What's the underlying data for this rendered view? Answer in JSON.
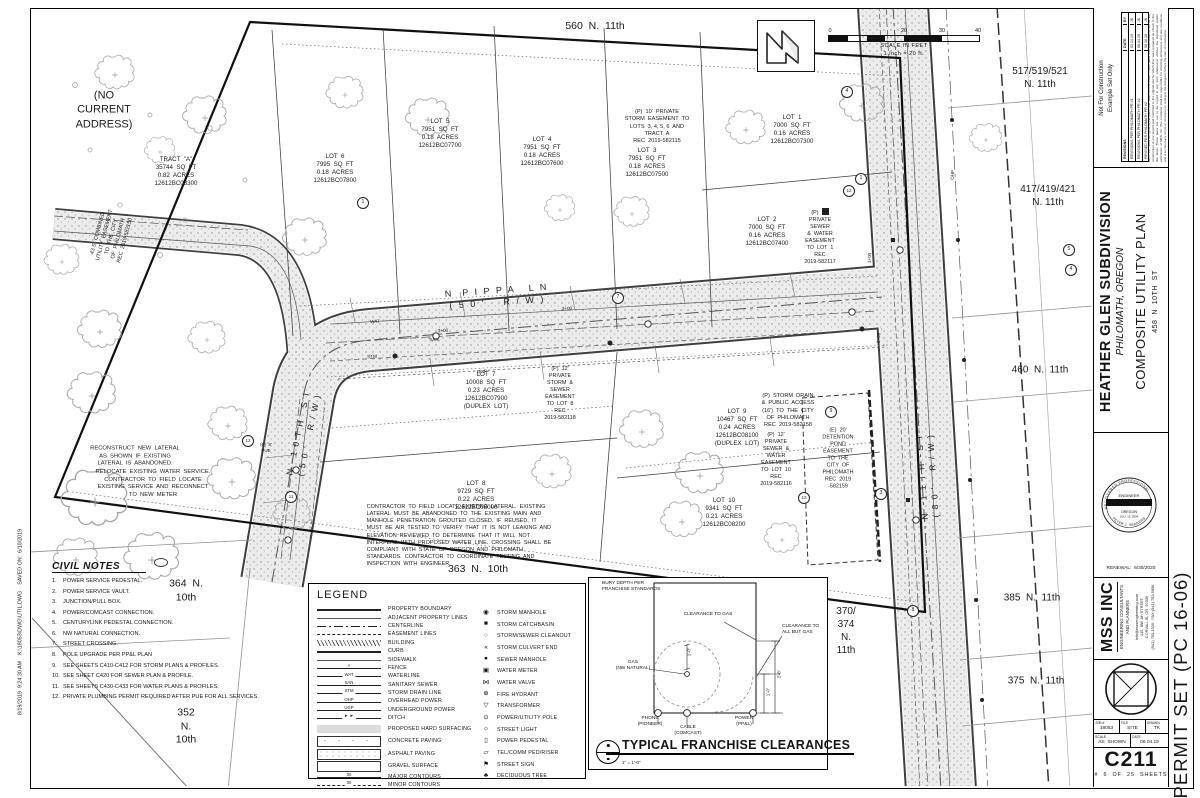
{
  "plan": {
    "annotations": [
      {
        "n": "addr-560",
        "t": "560  N.  11th",
        "x": 595,
        "y": 27,
        "fs": 10.5
      },
      {
        "n": "no-current-address",
        "t": "(NO\nCURRENT\nADDRESS)",
        "x": 104,
        "y": 110,
        "fs": 11
      },
      {
        "n": "addr-517-519-521",
        "t": "517/519/521\nN. 11th",
        "x": 1040,
        "y": 78,
        "fs": 10
      },
      {
        "n": "addr-417-419-421",
        "t": "417/419/421\nN. 11th",
        "x": 1048,
        "y": 196,
        "fs": 10
      },
      {
        "n": "addr-460",
        "t": "460  N.  11th",
        "x": 1040,
        "y": 370,
        "fs": 10
      },
      {
        "n": "addr-385",
        "t": "385  N.  11th",
        "x": 1032,
        "y": 598,
        "fs": 10
      },
      {
        "n": "addr-375",
        "t": "375  N.  11th",
        "x": 1036,
        "y": 681,
        "fs": 10
      },
      {
        "n": "addr-370-374",
        "t": "370/\n374\nN.\n11th",
        "x": 846,
        "y": 631,
        "fs": 10
      },
      {
        "n": "addr-364",
        "t": "364  N.\n10th",
        "x": 186,
        "y": 591,
        "fs": 10.5
      },
      {
        "n": "addr-352",
        "t": "352\nN.\n10th",
        "x": 186,
        "y": 727,
        "fs": 10.5
      },
      {
        "n": "addr-363",
        "t": "363  N.  10th",
        "x": 478,
        "y": 570,
        "fs": 10.5
      },
      {
        "n": "street-n-pippa-ln",
        "t": "N  P I P P A   L N\n( 5 0 '    R / W )",
        "x": 497,
        "y": 297,
        "fs": 9,
        "rot": -4,
        "ls": 2
      },
      {
        "n": "street-n-10th-st",
        "t": "N   1 0 T H   S T\n( 5 0 '    R / W )",
        "x": 304,
        "y": 434,
        "fs": 8.5,
        "rot": -78,
        "ls": 1.5
      },
      {
        "n": "street-n-11th-st",
        "t": "N   1 1 T H   S T\n( 8 0 '    R / W )",
        "x": 928,
        "y": 476,
        "fs": 8.5,
        "rot": -94,
        "ls": 1.5
      },
      {
        "n": "tract-a-label",
        "t": "TRACT  \"A\"\n35744  SQ  FT\n0.82  ACRES\n12612BC08300",
        "x": 176,
        "y": 172,
        "fs": 6.2
      },
      {
        "n": "lot-6-label",
        "t": "LOT  6\n7995  SQ  FT\n0.18  ACRES\n12612BC07800",
        "x": 335,
        "y": 169,
        "fs": 6.2
      },
      {
        "n": "lot-5-label",
        "t": "LOT  5\n7951  SQ  FT\n0.18  ACRES\n12612BC07700",
        "x": 440,
        "y": 134,
        "fs": 6.2
      },
      {
        "n": "lot-4-label",
        "t": "LOT  4\n7951  SQ  FT\n0.18  ACRES\n12612BC07600",
        "x": 542,
        "y": 152,
        "fs": 6.2
      },
      {
        "n": "lot-3-label",
        "t": "LOT  3\n7951  SQ  FT\n0.18  ACRES\n12612BC07500",
        "x": 647,
        "y": 163,
        "fs": 6.2
      },
      {
        "n": "lot-1-label",
        "t": "LOT  1\n7000  SQ  FT\n0.16  ACRES\n12612BC07300",
        "x": 792,
        "y": 130,
        "fs": 6.2
      },
      {
        "n": "lot-2-label",
        "t": "LOT  2\n7000  SQ  FT\n0.16  ACRES\n12612BC07400",
        "x": 767,
        "y": 232,
        "fs": 6.2
      },
      {
        "n": "lot-7-label",
        "t": "LOT  7\n10008  SQ  FT\n0.23  ACRES\n12612BC07900\n(DUPLEX  LOT)",
        "x": 486,
        "y": 391,
        "fs": 6.2
      },
      {
        "n": "lot-8-label",
        "t": "LOT  8\n9729  SQ  FT\n0.22  ACRES\n12612BC08000",
        "x": 476,
        "y": 496,
        "fs": 6.2
      },
      {
        "n": "lot-9-label",
        "t": "LOT  9\n10467  SQ  FT\n0.24  ACRES\n12612BC08100\n(DUPLEX  LOT)",
        "x": 737,
        "y": 428,
        "fs": 6.2
      },
      {
        "n": "lot-10-label",
        "t": "LOT  10\n9341  SQ  FT\n0.21  ACRES\n12612BC08200",
        "x": 724,
        "y": 513,
        "fs": 6.2
      },
      {
        "n": "esmt-storm-lots-3456",
        "t": "(P)  10'  PRIVATE\nSTORM  EASEMENT  TO\nLOTS  3, 4, 5, 6  AND\nTRACT  A\nREC  2019-582115",
        "x": 657,
        "y": 127,
        "fs": 5.6
      },
      {
        "n": "esmt-sewer-water-lot1",
        "t": "(P)  12'\nPRIVATE\nSEWER\n&  WATER\nEASEMENT\nTO  LOT  1\nREC\n2019-582117",
        "x": 820,
        "y": 238,
        "fs": 5.4
      },
      {
        "n": "esmt-storm-sewer-lot8",
        "t": "(P)  12'\nPRIVATE\nSTORM  &\nSEWER\nEASEMENT\nTO  LOT  8\nREC\n2019-582118",
        "x": 560,
        "y": 394,
        "fs": 5.4
      },
      {
        "n": "esmt-storm-drain-public",
        "t": "(P)  STORM  DRAIN\n&  PUBLIC  ACCESS\n(16')  TO  THE  CITY\nOF  PHILOMATH\nREC  2019-582158",
        "x": 788,
        "y": 411,
        "fs": 5.6
      },
      {
        "n": "esmt-sewer-water-lot10",
        "t": "(P)  12'\nPRIVATE\nSEWER  &\nWATER\nEASEMENT\nTO  LOT  10\nREC\n2019-582116",
        "x": 776,
        "y": 460,
        "fs": 5.4
      },
      {
        "n": "esmt-detention-pond",
        "t": "(E)  20'\nDETENTION\nPOND\nEASEMENT\nTO  THE\nCITY  OF\nPHILOMATH\nREC  2019\n-582159",
        "x": 838,
        "y": 459,
        "fs": 5.4
      },
      {
        "n": "esmt-combined-utility",
        "t": "43.5'  COMBINED\nUTILITY  EASEMENT\nTO  THE  CITY\nOF  PHILOMATH\nREC  2019-582150",
        "x": 112,
        "y": 237,
        "fs": 5.4,
        "rot": -75
      },
      {
        "n": "note-reconstruct-lateral",
        "t": "RECONSTRUCT  NEW  LATERAL\nAS  SHOWN  IF  EXISTING\nLATERAL  IS  ABANDONED.",
        "x": 135,
        "y": 457,
        "fs": 5.8
      },
      {
        "n": "note-relocate-water",
        "t": "RELOCATE  EXISTING  WATER  SERVICE.\nCONTRACTOR  TO  FIELD  LOCATE\nEXISTING  SERVICE  AND  RECONNECT\nTO  NEW  METER",
        "x": 153,
        "y": 484,
        "fs": 5.8
      },
      {
        "n": "note-contractor-lateral",
        "t": "CONTRACTOR  TO  FIELD  LOCATE  EXISTING  LATERAL.  EXISTING\nLATERAL  MUST  BE  ABANDONED  TO  THE  EXISTING  MAIN  AND\nMANHOLE  PENETRATION  GROUTED  CLOSED.  IF  REUSED,  IT\nMUST  BE  AIR  TESTED  TO  VERIFY  THAT  IT  IS  NOT  LEAKING  AND\nELEVATION  REVIEWED  TO  DETERMINE  THAT  IT  WILL  NOT\nINTERFERE  WITH  PROPOSED  WATER  LINE.  CROSSING  SHALL  BE\nCOMPLIANT  WITH  STATE  OF  OREGON  AND  PHILOMATH\nSTANDARDS.  CONTRACTOR  TO  COORDINATE  TESTING  AND\nINSPECTION  WITH  ENGINEER.",
        "x": 459,
        "y": 536,
        "fs": 5.5,
        "al": "left"
      },
      {
        "n": "pue-note",
        "t": "(E)  8'\nPUE",
        "x": 266,
        "y": 448,
        "fs": 4.5
      },
      {
        "n": "utility-tag-wat",
        "t": "WAT",
        "x": 375,
        "y": 322,
        "fs": 4.6,
        "rot": -3
      },
      {
        "n": "utility-tag-san",
        "t": "SAN",
        "x": 434,
        "y": 340,
        "fs": 4.6,
        "rot": -3
      },
      {
        "n": "utility-tag-stm",
        "t": "STM",
        "x": 372,
        "y": 357,
        "fs": 4.6,
        "rot": -3
      },
      {
        "n": "utility-tag-ugp",
        "t": "UGP",
        "x": 482,
        "y": 372,
        "fs": 4.6,
        "rot": -3
      },
      {
        "n": "utility-tag-ohp",
        "t": "OHP",
        "x": 953,
        "y": 175,
        "fs": 4.6,
        "rot": -87
      },
      {
        "n": "station-3-00-a",
        "t": "3+00",
        "x": 443,
        "y": 331,
        "fs": 4.6,
        "rot": -3
      },
      {
        "n": "station-3-00-b",
        "t": "3+00",
        "x": 567,
        "y": 309,
        "fs": 4.6,
        "rot": -3
      },
      {
        "n": "station-1-00",
        "t": "1+00",
        "x": 870,
        "y": 258,
        "fs": 4.6,
        "rot": -87
      },
      {
        "n": "station-0-00",
        "t": "0+00",
        "x": 879,
        "y": 338,
        "fs": 4.6,
        "rot": -87
      },
      {
        "n": "callout-1a",
        "t": "1",
        "x": 363,
        "y": 203,
        "fs": 5.2,
        "c": true
      },
      {
        "n": "callout-4a",
        "t": "4",
        "x": 847,
        "y": 92,
        "fs": 5.2,
        "c": true
      },
      {
        "n": "callout-1b",
        "t": "1",
        "x": 861,
        "y": 179,
        "fs": 5.2,
        "c": true
      },
      {
        "n": "callout-12a",
        "t": "12",
        "x": 849,
        "y": 191,
        "fs": 4.6,
        "c": true
      },
      {
        "n": "callout-7",
        "t": "7",
        "x": 618,
        "y": 298,
        "fs": 5.2,
        "c": true
      },
      {
        "n": "callout-9",
        "t": "9",
        "x": 831,
        "y": 412,
        "fs": 5.2,
        "c": true
      },
      {
        "n": "callout-3",
        "t": "3",
        "x": 881,
        "y": 494,
        "fs": 5.2,
        "c": true
      },
      {
        "n": "callout-12b",
        "t": "12",
        "x": 804,
        "y": 498,
        "fs": 4.6,
        "c": true
      },
      {
        "n": "callout-12c",
        "t": "12",
        "x": 248,
        "y": 441,
        "fs": 4.6,
        "c": true
      },
      {
        "n": "callout-11",
        "t": "11",
        "x": 291,
        "y": 497,
        "fs": 4.6,
        "c": true
      },
      {
        "n": "callout-8",
        "t": "8",
        "x": 913,
        "y": 611,
        "fs": 5.2,
        "c": true
      },
      {
        "n": "callout-5",
        "t": "5",
        "x": 1069,
        "y": 250,
        "fs": 5.2,
        "c": true
      },
      {
        "n": "callout-4b",
        "t": "4",
        "x": 1071,
        "y": 270,
        "fs": 5.2,
        "c": true
      },
      {
        "n": "file-path-note",
        "t": "8/19/2019  9:24:30 AM    K:\\18053\\DWG\\UTIL.DWG    SAVED ON:  6/10/2019",
        "x": 21,
        "y": 622,
        "fs": 5.4,
        "rot": -90
      }
    ]
  },
  "north_scale": {
    "ticks": [
      "0",
      "20",
      "30",
      "40"
    ],
    "caption": "SCALE  IN  FEET",
    "sub": "1  inch  =  20  ft."
  },
  "civil_notes": {
    "title": "CIVIL NOTES",
    "items": [
      "POWER SERVICE PEDESTAL.",
      "POWER SERVICE VAULT.",
      "JUNCTION/PULL BOX.",
      "POWER/COMCAST CONNECTION.",
      "CENTURYLINK PEDESTAL CONNECTION.",
      "NW NATURAL CONNECTION.",
      "STREET CROSSING.",
      "POLE UPGRADE PER PP&L PLAN",
      "SEE SHEETS C410-C412 FOR STORM PLANS & PROFILES.",
      "SEE SHEET C420 FOR SEWER PLAN & PROFILE.",
      "SEE SHEETS C430-C433 FOR WATER PLANS & PROFILES.",
      "PRIVATE PLUMBING PERMIT REQUIRED AFTER PUE FOR ALL SERVICES."
    ]
  },
  "legend": {
    "title": "LEGEND",
    "lines": [
      {
        "label": "PROPERTY BOUNDARY",
        "style": "thick"
      },
      {
        "label": "ADJACENT PROPERTY LINES",
        "style": "thin"
      },
      {
        "label": "CENTERLINE",
        "style": "dashdot"
      },
      {
        "label": "EASEMENT LINES",
        "style": "dash"
      },
      {
        "label": "BUILDING",
        "style": "hatch"
      },
      {
        "label": "CURB",
        "style": "thick"
      },
      {
        "label": "SIDEWALK",
        "style": "thin"
      },
      {
        "label": "FENCE",
        "style": "fence",
        "tag": "×"
      },
      {
        "label": "WATERLINE",
        "style": "tagline",
        "tag": "WAT"
      },
      {
        "label": "SANITARY SEWER",
        "style": "tagline",
        "tag": "SAN"
      },
      {
        "label": "STORM DRAIN LINE",
        "style": "tagline",
        "tag": "STM"
      },
      {
        "label": "OVERHEAD POWER",
        "style": "tagline",
        "tag": "OHP"
      },
      {
        "label": "UNDERGROUND POWER",
        "style": "tagline",
        "tag": "UGP"
      },
      {
        "label": "DITCH",
        "style": "ditch",
        "tag": "►  ►"
      },
      {
        "label": "PROPOSED HARD SURFACING",
        "style": "swatch-gray",
        "tall": true
      },
      {
        "label": "CONCRETE PAVING",
        "style": "swatch-conc",
        "tall": true
      },
      {
        "label": "ASPHALT PAVING",
        "style": "swatch-asph",
        "tall": true
      },
      {
        "label": "GRAVEL SURFACE",
        "style": "swatch-plain",
        "tall": true
      },
      {
        "label": "MAJOR CONTOURS",
        "style": "contour",
        "tag": "30"
      },
      {
        "label": "MINOR CONTOURS",
        "style": "contour-minor",
        "tag": "30"
      }
    ],
    "symbols": [
      {
        "label": "STORM MANHOLE",
        "glyph": "◉",
        "name": "storm-manhole-icon"
      },
      {
        "label": "STORM CATCHBASIN",
        "glyph": "■",
        "name": "storm-catchbasin-icon"
      },
      {
        "label": "STORM/SEWER CLEANOUT",
        "glyph": "○",
        "name": "storm-sewer-cleanout-icon"
      },
      {
        "label": "STORM CULVERT END",
        "glyph": "«",
        "name": "storm-culvert-end-icon"
      },
      {
        "label": "SEWER MANHOLE",
        "glyph": "●",
        "name": "sewer-manhole-icon"
      },
      {
        "label": "WATER METER",
        "glyph": "▣",
        "name": "water-meter-icon"
      },
      {
        "label": "WATER VALVE",
        "glyph": "⋈",
        "name": "water-valve-icon"
      },
      {
        "label": "FIRE HYDRANT",
        "glyph": "⊕",
        "name": "fire-hydrant-icon"
      },
      {
        "label": "TRANSFORMER",
        "glyph": "▽",
        "name": "transformer-icon"
      },
      {
        "label": "POWER/UTILITY POLE",
        "glyph": "⊙",
        "name": "power-utility-pole-icon"
      },
      {
        "label": "STREET LIGHT",
        "glyph": "☼",
        "name": "street-light-icon"
      },
      {
        "label": "POWER PEDESTAL",
        "glyph": "▯",
        "name": "power-pedestal-icon"
      },
      {
        "label": "TEL/COMM PED/RISER",
        "glyph": "▱",
        "name": "tel-comm-ped-riser-icon"
      },
      {
        "label": "STREET SIGN",
        "glyph": "⚑",
        "name": "street-sign-icon"
      },
      {
        "label": "DECIDUOUS TREE",
        "glyph": "♣",
        "name": "deciduous-tree-icon"
      }
    ]
  },
  "franchise": {
    "title": "TYPICAL FRANCHISE CLEARANCES",
    "scale": "1\" = 1'-0\"",
    "bury": "BURY DEPTH PER\nFRANCHISE STANDARDS",
    "clearance_gas": "CLEARANCE TO GAS",
    "clearance_all": "CLEARANCE TO\nALL BUT GAS",
    "gas": "GAS\n(NW NATURAL)",
    "phone": "PHONE\n(PIONEER)",
    "cable": "CABLE\n(COMCAST)",
    "power": "POWER\n(PP&L)",
    "dim_gas": "1'-0\"",
    "dim_low": "1'-0\"",
    "dim_high": "2'-6\""
  },
  "titleblock": {
    "nfc": "Not For Construction\nExample Set Only",
    "revisions": {
      "header": "REVISIONS",
      "date_h": "DATE",
      "by_h": "BY",
      "rows": [
        {
          "desc": "REVISIONS PER PHILOMATH PR #1",
          "date": "03.14.19",
          "by": "JK"
        },
        {
          "desc": "REVISIONS PER PHILOMATH PR #2",
          "date": "06.04.19",
          "by": "JK"
        },
        {
          "desc": "REVISED PER PHILOMATH PR #2",
          "date": "08.10.19",
          "by": "JK"
        }
      ]
    },
    "disclaimer": "MSS, Inc. holds all rights to the plans and ideas on this sheet. These plans and specifications are for the construction of one project and restricted to the original site for which they were prepared as shown in the title block. These plans are not to be copied in any form whatsoever without the expressed written permission of MSS, Inc. The contractor shall be responsible for checking dimensions and site conditions and is to report any errors or omissions in writing to the designers before the start of construction.",
    "project": "HEATHER GLEN SUBDIVISION",
    "city": "PHILOMATH, OREGON",
    "sheet_title": "COMPOSITE UTILITY PLAN",
    "address": "458  N  10TH  ST",
    "stamp": {
      "arc_top": "REGISTERED PROFESSIONAL",
      "center": "ENGINEER",
      "state": "OREGON",
      "date": "JULY 13, 2004",
      "arc_bottom": "PETER J. SEAGERS",
      "renewal": "RENEWAL:  6/30/2020"
    },
    "firm": {
      "name": "MSS INC",
      "tagline": "ENGINEERING CONSULTANTS\nAND PLANNERS",
      "contact": "info@mssengineering.com\n215  NW 4th STREET\nCORVALLIS, OR  97330\n(541) 753-1320   FAX:(541) 753-5956"
    },
    "job": {
      "job_label": "JOB #",
      "job": "18053",
      "file_label": "FILE",
      "file": "SITE",
      "drawn_label": "DRAWN",
      "drawn": "TK",
      "scale_label": "SCALE",
      "scale": "AS  SHOWN",
      "date_label": "DATE",
      "date": "06.04.19"
    },
    "sheet_no": "C211",
    "sheet_count": "#  6  OF  25  SHEETS",
    "permit": "PERMIT SET (PC 16-06)"
  }
}
